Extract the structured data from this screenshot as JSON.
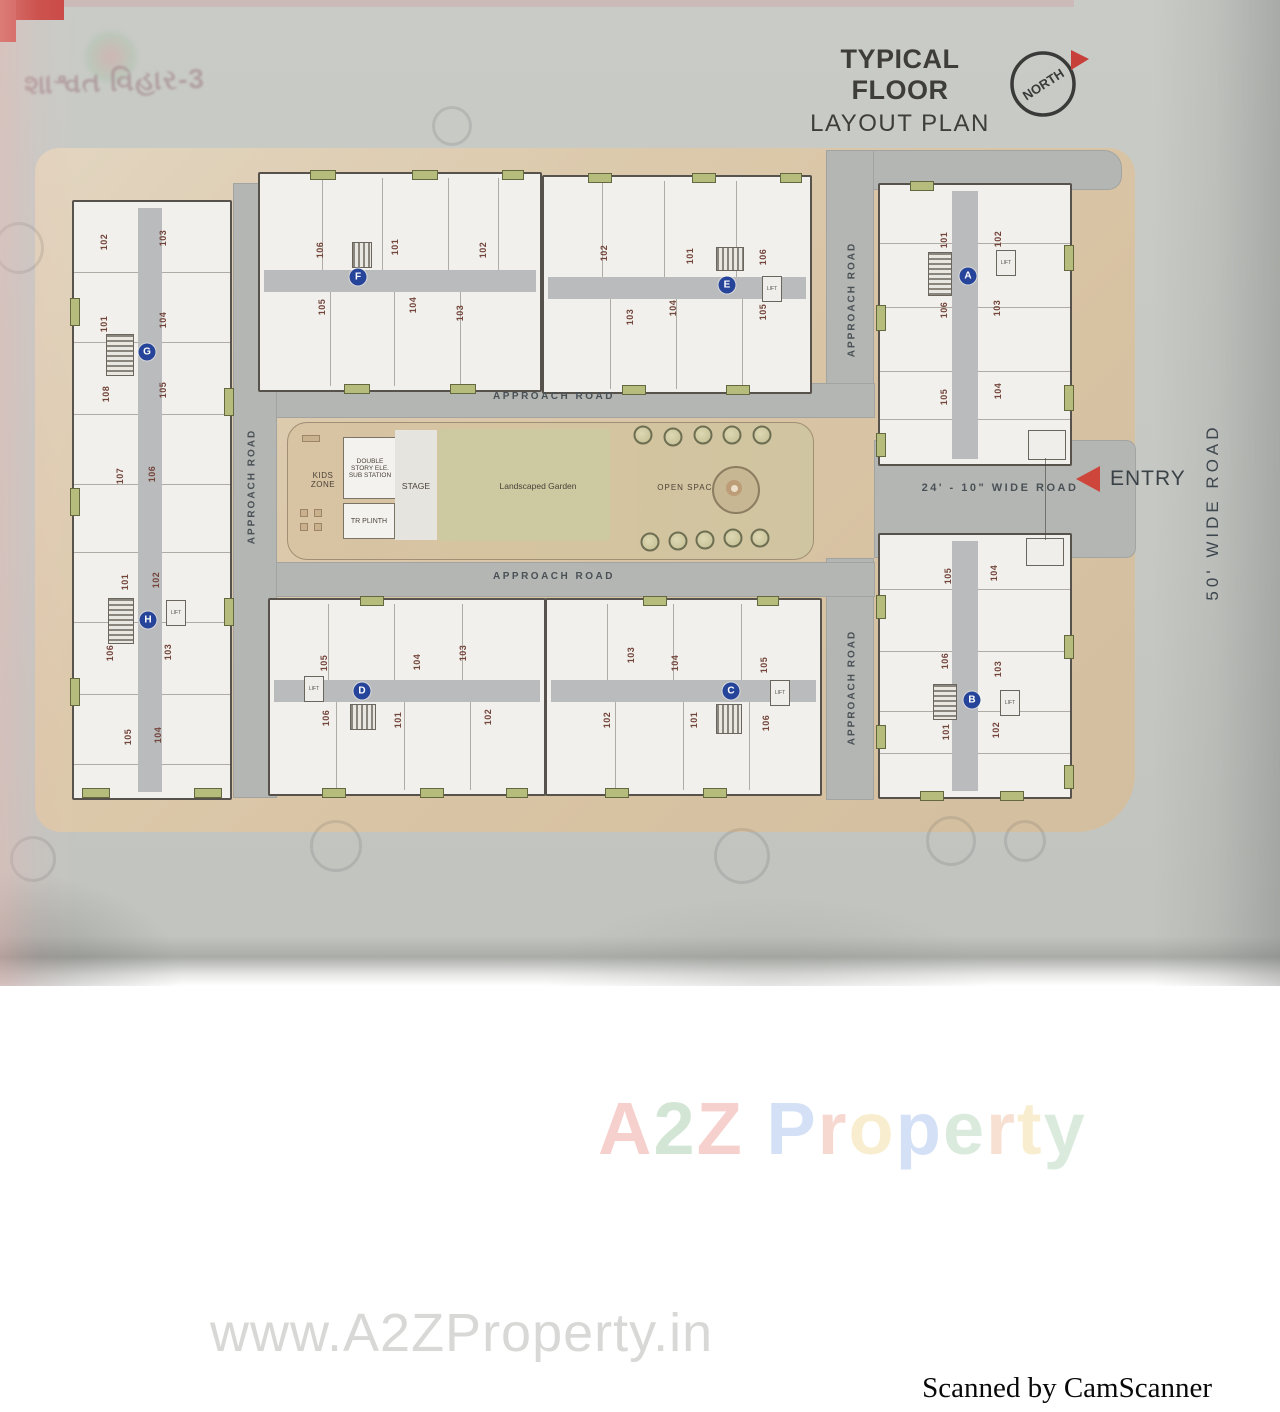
{
  "header": {
    "brand_mark": "શાશ્વત વિહાર-3",
    "title_line1": "TYPICAL FLOOR",
    "title_line2": "LAYOUT PLAN",
    "compass_label": "NORTH"
  },
  "roads": {
    "approach_road": "APPROACH ROAD",
    "wide_road_24": "24' - 10\" WIDE ROAD",
    "wide_road_50": "50' WIDE ROAD",
    "entry": "ENTRY"
  },
  "amenities": {
    "kids_zone": "KIDS ZONE",
    "sub_station": "DOUBLE STORY ELE. SUB STATION",
    "stage": "STAGE",
    "tr_plinth": "TR PLINTH",
    "garden": "Landscaped Garden",
    "open_space": "OPEN SPACE",
    "lift": "LIFT"
  },
  "blocks": [
    {
      "id": "G",
      "cx": 147,
      "cy": 352,
      "units": [
        {
          "n": "102",
          "x": 104,
          "y": 242
        },
        {
          "n": "103",
          "x": 163,
          "y": 238
        },
        {
          "n": "101",
          "x": 104,
          "y": 324
        },
        {
          "n": "104",
          "x": 163,
          "y": 320
        },
        {
          "n": "108",
          "x": 106,
          "y": 394
        },
        {
          "n": "105",
          "x": 163,
          "y": 390
        },
        {
          "n": "107",
          "x": 120,
          "y": 476
        },
        {
          "n": "106",
          "x": 152,
          "y": 474
        }
      ]
    },
    {
      "id": "H",
      "cx": 148,
      "cy": 620,
      "units": [
        {
          "n": "101",
          "x": 125,
          "y": 582
        },
        {
          "n": "102",
          "x": 156,
          "y": 580
        },
        {
          "n": "106",
          "x": 110,
          "y": 653
        },
        {
          "n": "103",
          "x": 168,
          "y": 652
        },
        {
          "n": "105",
          "x": 128,
          "y": 737
        },
        {
          "n": "104",
          "x": 158,
          "y": 735
        }
      ]
    },
    {
      "id": "F",
      "cx": 358,
      "cy": 277,
      "units": [
        {
          "n": "106",
          "x": 320,
          "y": 250
        },
        {
          "n": "101",
          "x": 395,
          "y": 247
        },
        {
          "n": "102",
          "x": 483,
          "y": 250
        },
        {
          "n": "105",
          "x": 322,
          "y": 307
        },
        {
          "n": "104",
          "x": 413,
          "y": 305
        },
        {
          "n": "103",
          "x": 460,
          "y": 313
        }
      ]
    },
    {
      "id": "E",
      "cx": 727,
      "cy": 285,
      "units": [
        {
          "n": "102",
          "x": 604,
          "y": 253
        },
        {
          "n": "101",
          "x": 690,
          "y": 256
        },
        {
          "n": "106",
          "x": 763,
          "y": 257
        },
        {
          "n": "103",
          "x": 630,
          "y": 317
        },
        {
          "n": "104",
          "x": 673,
          "y": 308
        },
        {
          "n": "105",
          "x": 763,
          "y": 312
        }
      ]
    },
    {
      "id": "A",
      "cx": 968,
      "cy": 276,
      "units": [
        {
          "n": "101",
          "x": 944,
          "y": 240
        },
        {
          "n": "102",
          "x": 998,
          "y": 239
        },
        {
          "n": "106",
          "x": 944,
          "y": 310
        },
        {
          "n": "103",
          "x": 997,
          "y": 308
        },
        {
          "n": "105",
          "x": 944,
          "y": 397
        },
        {
          "n": "104",
          "x": 998,
          "y": 391
        }
      ]
    },
    {
      "id": "B",
      "cx": 972,
      "cy": 700,
      "units": [
        {
          "n": "105",
          "x": 948,
          "y": 576
        },
        {
          "n": "104",
          "x": 994,
          "y": 573
        },
        {
          "n": "106",
          "x": 945,
          "y": 661
        },
        {
          "n": "103",
          "x": 998,
          "y": 669
        },
        {
          "n": "101",
          "x": 946,
          "y": 732
        },
        {
          "n": "102",
          "x": 996,
          "y": 730
        }
      ]
    },
    {
      "id": "D",
      "cx": 362,
      "cy": 691,
      "units": [
        {
          "n": "105",
          "x": 324,
          "y": 663
        },
        {
          "n": "104",
          "x": 417,
          "y": 662
        },
        {
          "n": "103",
          "x": 463,
          "y": 653
        },
        {
          "n": "106",
          "x": 326,
          "y": 718
        },
        {
          "n": "101",
          "x": 398,
          "y": 720
        },
        {
          "n": "102",
          "x": 488,
          "y": 717
        }
      ]
    },
    {
      "id": "C",
      "cx": 731,
      "cy": 691,
      "units": [
        {
          "n": "103",
          "x": 631,
          "y": 655
        },
        {
          "n": "104",
          "x": 675,
          "y": 663
        },
        {
          "n": "105",
          "x": 764,
          "y": 665
        },
        {
          "n": "102",
          "x": 607,
          "y": 720
        },
        {
          "n": "101",
          "x": 694,
          "y": 720
        },
        {
          "n": "106",
          "x": 766,
          "y": 723
        }
      ]
    }
  ],
  "lifts": [
    [
      166,
      600
    ],
    [
      762,
      276
    ],
    [
      996,
      250
    ],
    [
      1000,
      690
    ],
    [
      304,
      676
    ],
    [
      770,
      680
    ]
  ],
  "trees": [
    [
      643,
      435
    ],
    [
      673,
      437
    ],
    [
      703,
      435
    ],
    [
      732,
      435
    ],
    [
      762,
      435
    ],
    [
      650,
      542
    ],
    [
      678,
      541
    ],
    [
      705,
      540
    ],
    [
      733,
      538
    ],
    [
      760,
      538
    ]
  ],
  "watermarks": {
    "brand": [
      {
        "ch": "A",
        "color": "#eda29c"
      },
      {
        "ch": "2",
        "color": "#a8cfad"
      },
      {
        "ch": "Z",
        "color": "#eda29c"
      },
      {
        "ch": " ",
        "color": "#ffffff"
      },
      {
        "ch": "P",
        "color": "#a9c3ee"
      },
      {
        "ch": "r",
        "color": "#f0b2a2"
      },
      {
        "ch": "o",
        "color": "#f2dfa0"
      },
      {
        "ch": "p",
        "color": "#a9c3ee"
      },
      {
        "ch": "e",
        "color": "#b7d8bc"
      },
      {
        "ch": "r",
        "color": "#f0c1a4"
      },
      {
        "ch": "t",
        "color": "#f2dfa0"
      },
      {
        "ch": "y",
        "color": "#b7d8bc"
      }
    ],
    "url": "www.A2ZProperty.in",
    "scan_note": "Scanned by CamScanner"
  },
  "colors": {
    "accent_red": "#c8403a",
    "road_gray": "#b4b6b3",
    "plan_tan": "#d9c5a8",
    "block_circle_blue": "#26459a",
    "unit_text_brown": "#73453b",
    "balcony_green": "#b6bd7c"
  }
}
